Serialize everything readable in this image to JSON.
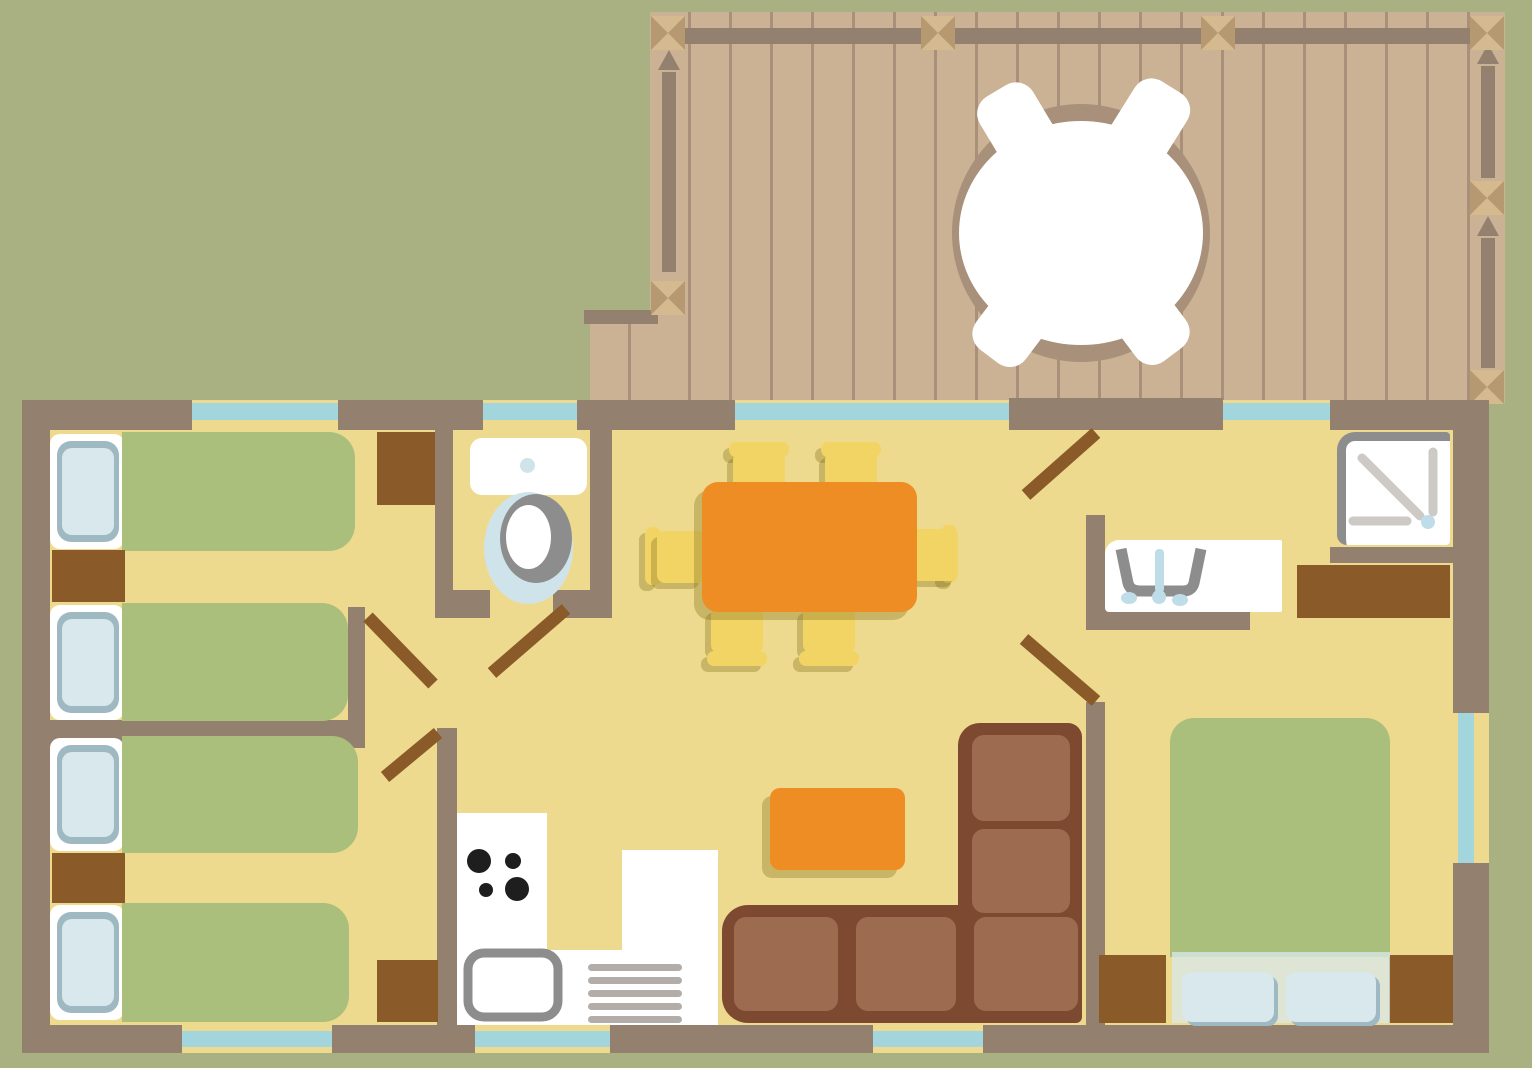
{
  "palette": {
    "bg": "#a9b183",
    "deck": "#cbb294",
    "plank": "#a8907a",
    "wall": "#94806e",
    "post_light": "#d5ba90",
    "post_dark": "#b69871",
    "floor": "#eeda8e",
    "glass": "#a3d5dd",
    "wood_dark": "#8a5a28",
    "bed_green": "#abbf7d",
    "pillow": "#d9e8ec",
    "pillow_edge": "#9fb9c3",
    "white": "#ffffff",
    "orange": "#ee8d24",
    "chair": "#f2d464",
    "shadow": "rgba(128,112,28,0.35)",
    "sofa_base": "#7d4930",
    "sofa_cushion": "#9d6c50",
    "gray": "#8d8d8d",
    "light_gray": "#cdc9c4",
    "drainer": "#b2ada8",
    "bowl": "#cfe4ea",
    "faucet": "#bfdde8",
    "burner": "#1e1e1e"
  },
  "plan": {
    "type": "floor-plan",
    "areas": [
      {
        "id": "deck",
        "furniture": [
          "round-table",
          "deck-chair",
          "deck-chair",
          "deck-chair",
          "deck-chair"
        ],
        "features": [
          "railing",
          "cross-posts",
          "plank-decking"
        ]
      },
      {
        "id": "bedroom-1",
        "furniture": [
          "single-bed",
          "single-bed",
          "nightstand",
          "wardrobe"
        ],
        "windows": 1,
        "doors": 1
      },
      {
        "id": "bedroom-2",
        "furniture": [
          "single-bed",
          "single-bed",
          "nightstand",
          "wardrobe"
        ],
        "windows": 1,
        "doors": 1
      },
      {
        "id": "wc",
        "furniture": [
          "toilet"
        ],
        "windows": 1,
        "doors": 1
      },
      {
        "id": "kitchen-dining",
        "furniture": [
          "dining-table",
          "dining-chair",
          "dining-chair",
          "dining-chair",
          "dining-chair",
          "dining-chair",
          "dining-chair",
          "stove",
          "kitchen-sink",
          "dish-drainer",
          "counter"
        ],
        "windows": 2
      },
      {
        "id": "living",
        "furniture": [
          "corner-sofa",
          "coffee-table"
        ],
        "windows": 1
      },
      {
        "id": "shower-room",
        "furniture": [
          "shower-tray",
          "washbasin",
          "counter"
        ],
        "windows": 1,
        "doors": 1
      },
      {
        "id": "bedroom-3",
        "furniture": [
          "double-bed",
          "nightstand",
          "nightstand"
        ],
        "windows": 1,
        "doors": 1
      }
    ],
    "totals": {
      "windows": 7,
      "interior_door_leaves": 5,
      "single_beds": 4,
      "double_beds": 1
    }
  }
}
